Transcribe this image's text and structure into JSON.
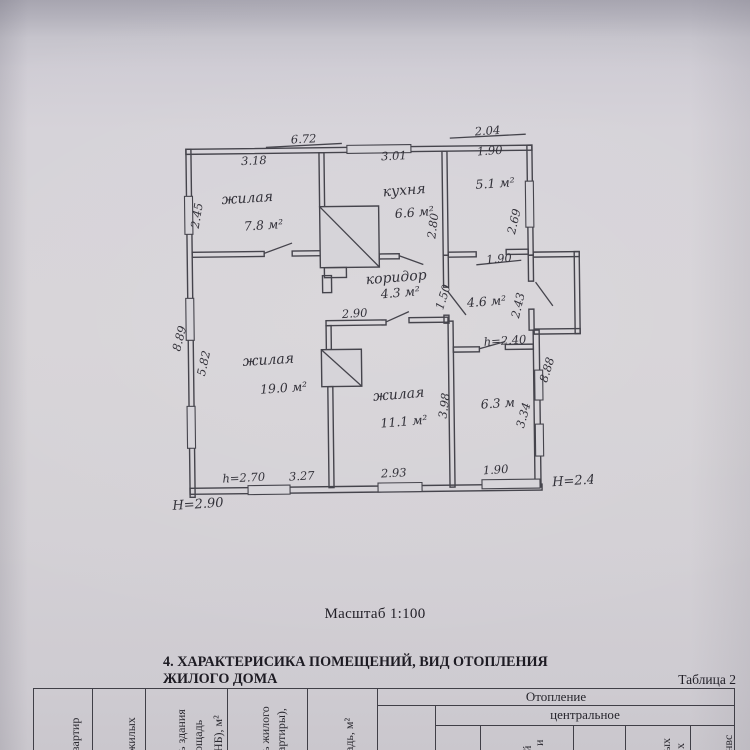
{
  "document": {
    "scale_note": "Масштаб 1:100",
    "section_heading": "4. ХАРАКТЕРИСИКА ПОМЕЩЕНИЙ, ВИД ОТОПЛЕНИЯ ЖИЛОГО ДОМА",
    "table_caption": "Таблица 2"
  },
  "plan": {
    "rooms": {
      "living1_name": "жилая",
      "living1_area": "7.8 м²",
      "kitchen_name": "кухня",
      "kitchen_area": "6.6 м²",
      "top_right_area": "5.1 м²",
      "corridor_name": "коридор",
      "corridor_area": "4.3 м²",
      "hall_area": "4.6 м²",
      "living2_name": "жилая",
      "living2_area": "19.0 м²",
      "living3_name": "жилая",
      "living3_area": "11.1 м²",
      "bottom_right_area": "6.3 м"
    },
    "dims": {
      "top_672": "6.72",
      "top_204": "2.04",
      "w_318": "3.18",
      "w_301": "3.01",
      "w_190_top": "1.90",
      "h_245": "2.45",
      "h_280": "2.80",
      "h_269": "2.69",
      "w_190_mid": "1.90",
      "h_150": "1.50",
      "h_243": "2.43",
      "h_240": "h=2.40",
      "side_888": "8.88",
      "side_889": "8.89",
      "h_582": "5.82",
      "w_290": "2.90",
      "h_398": "3.98",
      "h_334": "3.34",
      "h_270": "h=2.70",
      "w_327": "3.27",
      "w_293": "2.93",
      "w_190_bot": "1.90",
      "height_290": "H=2.90",
      "height_245": "H=2.45"
    }
  },
  "table": {
    "heating_title": "Отопление",
    "heating_central_label": "центральное",
    "col1_fragment": "вартир",
    "col2_fragment": "жилых",
    "col3_fragment_line1": "ь здания",
    "col3_fragment_line2": "ощадь",
    "col3_fragment_line3": "НБ), м²",
    "col4_fragment_line1": "ь жилого",
    "col4_fragment_line2": "артиры),",
    "col5_fragment": "адь, м²",
    "sub_fragment_1a": "й",
    "sub_fragment_1b": "и",
    "sub_fragment_2a": "ых",
    "sub_fragment_2b": "х",
    "sub_fragment_3": "нвс"
  }
}
